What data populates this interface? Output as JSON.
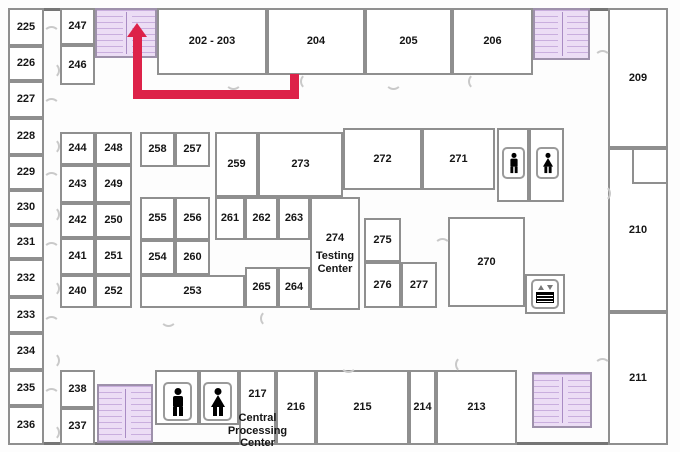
{
  "title": "Second floor plan with route to northwest stairwell",
  "colors": {
    "route": "#dd2249",
    "stair_fill": "#ecddf5",
    "stair_line": "#c9aede",
    "wall": "#8f8f8f",
    "label": "#151515"
  },
  "icons": {
    "male_restroom": "man-silhouette",
    "female_restroom": "woman-silhouette",
    "elevator": "elevator-call-panel",
    "stairwell": "stair-treads-hatch",
    "route_arrow": "arrow-up"
  },
  "rooms": {
    "202_203": "202 - 203",
    "204": "204",
    "205": "205",
    "206": "206",
    "209": "209",
    "210": "210",
    "211": "211",
    "213": "213",
    "214": "214",
    "215": "215",
    "216": "216",
    "217_num": "217",
    "217_name": "Central Processing Center",
    "225": "225",
    "226": "226",
    "227": "227",
    "228": "228",
    "229": "229",
    "230": "230",
    "231": "231",
    "232": "232",
    "233": "233",
    "234": "234",
    "235": "235",
    "236": "236",
    "237": "237",
    "238": "238",
    "240": "240",
    "241": "241",
    "242": "242",
    "243": "243",
    "244": "244",
    "246": "246",
    "247": "247",
    "248": "248",
    "249": "249",
    "250": "250",
    "251": "251",
    "252": "252",
    "253": "253",
    "254": "254",
    "255": "255",
    "256": "256",
    "257": "257",
    "258": "258",
    "259": "259",
    "260": "260",
    "261": "261",
    "262": "262",
    "263": "263",
    "264": "264",
    "265": "265",
    "270": "270",
    "271": "271",
    "272": "272",
    "273": "273",
    "274_num": "274",
    "274_name": "Testing Center",
    "275": "275",
    "276": "276",
    "277": "277"
  }
}
